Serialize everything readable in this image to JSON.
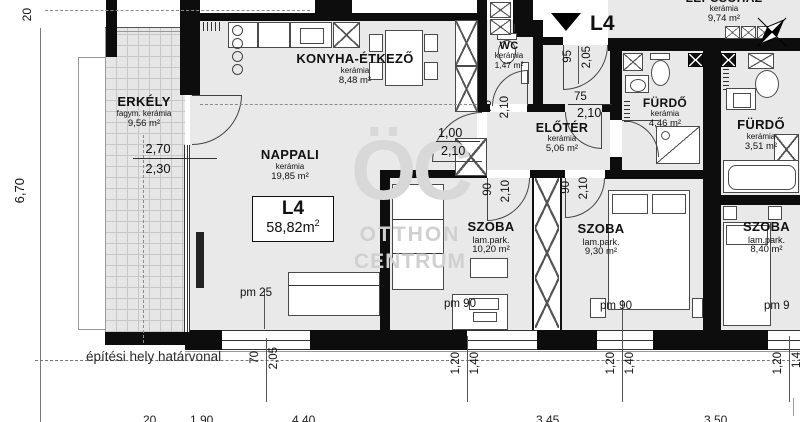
{
  "unit": {
    "code": "L4",
    "area": "58,82m",
    "area_sup": "2"
  },
  "entrance": {
    "marker": "L4"
  },
  "watermark": {
    "line1": "ÖC",
    "line2": "OTTHON",
    "line3": "CENTRUM"
  },
  "boundary_label": "építési hely határvonal",
  "rooms": {
    "erkely": {
      "name": "ERKÉLY",
      "finish": "fagym. kerámia",
      "area": "9,56 m²"
    },
    "konyha": {
      "name": "KONYHA-ÉTKEZŐ",
      "finish": "kerámia",
      "area": "8,48 m²"
    },
    "nappali": {
      "name": "NAPPALI",
      "finish": "kerámia",
      "area": "19,85 m²"
    },
    "wc": {
      "name": "WC",
      "finish": "kerámia",
      "area": "1,47 m²"
    },
    "eloter": {
      "name": "ELŐTÉR",
      "finish": "kerámia",
      "area": "5,06 m²"
    },
    "lepcsohaz": {
      "name": "LÉPCSŐHÁZ",
      "finish": "kerámia",
      "area": "9,74 m²"
    },
    "furdo1": {
      "name": "FÜRDŐ",
      "finish": "kerámia",
      "area": "4,46 m²"
    },
    "furdo2": {
      "name": "FÜRDŐ",
      "finish": "kerámia",
      "area": "3,51 m²"
    },
    "szoba1": {
      "name": "SZOBA",
      "finish": "lam.park.",
      "area": "10,20 m²"
    },
    "szoba2": {
      "name": "SZOBA",
      "finish": "lam.park.",
      "area": "9,30 m²"
    },
    "szoba3": {
      "name": "SZOBA",
      "finish": "lam.park.",
      "area": "8,40 m²"
    }
  },
  "dims": {
    "top_left": "20",
    "left_height": "6,70",
    "balcony_top": "2,70",
    "balcony_bot": "2,30",
    "entry_w": "95",
    "entry_h": "2,05",
    "entry2_w": "75",
    "entry2_h": "2,10",
    "wc_w": "75",
    "wc_h": "2,10",
    "liv_w": "1,00",
    "liv_h": "2,10",
    "sz1_w": "90",
    "sz1_h": "2,10",
    "sz2_w": "90",
    "sz2_h": "2,10",
    "base_w": "70",
    "base_h": "2,05",
    "w1a": "1,20",
    "w1b": "1,40",
    "w2a": "1,20",
    "w2b": "1,40",
    "w3a": "1,20",
    "w3b": "1,4",
    "pm_liv": "pm 25",
    "pm_sz1": "pm 90",
    "pm_sz2": "pm 90",
    "pm_sz3": "pm 9",
    "cut1": "20",
    "cut2": "1,90",
    "cut3": "4,40",
    "cut4": "3,45",
    "cut5": "3,50"
  }
}
